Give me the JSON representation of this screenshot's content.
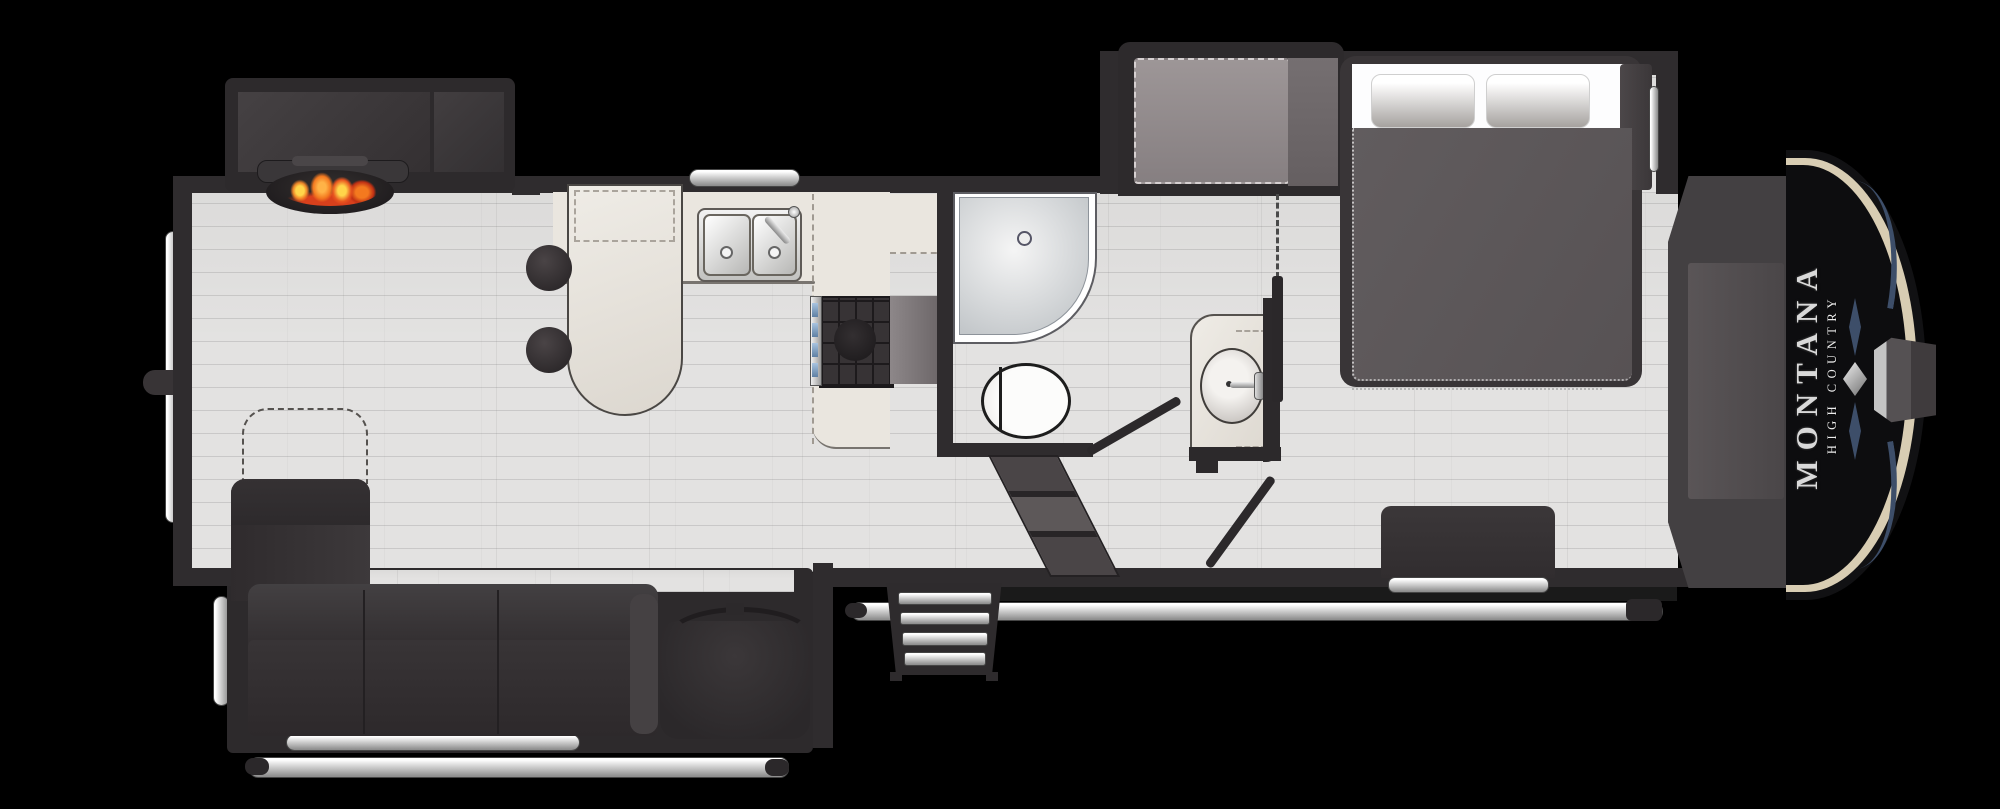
{
  "brand": {
    "line1": "MONTANA",
    "line2": "HIGH COUNTRY"
  },
  "diagram_type": "rv-fifth-wheel-floor-plan",
  "colors": {
    "background": "#000000",
    "walls": "#2f2c2e",
    "floor": "#e3e2e1",
    "counter": "#eae6df",
    "furniture_dark": "#363234",
    "steel": "#c9c9c9",
    "cap_black": "#0d0d0f",
    "cap_trim_cream": "#d8cdb3",
    "cap_accent_blue": "#3d4e69",
    "flame_orange": "#ff8a25",
    "flame_red": "#d8401c",
    "flame_yellow": "#ffd54a"
  },
  "fixtures": {
    "living": [
      "entertainment-slideout",
      "tv-console",
      "fireplace",
      "sectional-sofa",
      "accent-chair",
      "ottoman-outline"
    ],
    "kitchen": [
      "peninsula-counter",
      "bar-stools",
      "double-sink",
      "faucet",
      "kitchen-window",
      "range-stove",
      "oven",
      "refrigerator-cabinet",
      "linen-cabinet"
    ],
    "bathroom": [
      "corner-shower",
      "shower-drain",
      "toilet",
      "bathroom-door"
    ],
    "hall": [
      "interior-stairs",
      "vanity-sink",
      "vanity-faucet",
      "privacy-wall",
      "bedroom-door"
    ],
    "bedroom": [
      "wardrobe-slideout",
      "wardrobe-cabinet",
      "bed",
      "pillows",
      "comforter",
      "nightstand",
      "dresser"
    ],
    "exterior": [
      "entry-steps",
      "awning-rail",
      "slide-rails",
      "grab-handle",
      "rear-window",
      "rear-knob",
      "compartment-handle",
      "front-storage",
      "front-cap",
      "hitch-pin",
      "brand-logo"
    ]
  }
}
